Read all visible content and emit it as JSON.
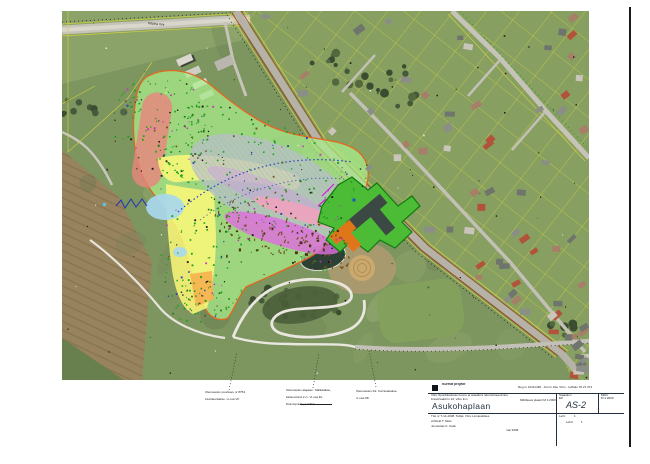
{
  "map": {
    "road_label": "Räpina mnt"
  },
  "annotations": [
    {
      "lines": [
        "Olemasolev puurkaev nr 8754.",
        "Likvideeritakse, vt osa VK"
      ]
    },
    {
      "lines": [
        "Olemasolev alajaam. Säilitatakse,",
        "kaitsevöönd 2 m. Vt osa EL",
        "liitumispunkt peakilbis"
      ]
    },
    {
      "lines": [
        "Olemasolev tiik. Korrastatakse,",
        "vt osa AB"
      ]
    }
  ],
  "title_block": {
    "logo_text": "Kurmik projekt",
    "top_right_line": "Reg nr 10411438 · Jüri tn 19a, Võru · tel/faks 78 21 373",
    "project_line1": "Võru Spordikeskuse hoone ja staadioni rekonstrueerimine",
    "project_line2": "Kreutzwaldi tn 16, Võru linn",
    "stage_note": "Mõõtkava plaanil M 1:2000",
    "title_main": "Asukohaplaan",
    "col_header1": "Staadium",
    "col_value1": "EP",
    "col_header2": "Mõõt",
    "col_value2": "M 1:2000",
    "code": "AS-2",
    "row3_line1": "Töö nr T-14-2008. Tellija: Võru Linnavalitsus",
    "row3_line2": "Arhitekt   T. Mets",
    "row3_line3": "Joonestas  K. Kask",
    "row3_center": "mai 2008",
    "sheet_label1": "Leht:",
    "sheet_value1": "1",
    "sheet_label2": "Lehti:",
    "sheet_value2": "1"
  },
  "colors": {
    "overlay_green": "#abef8c",
    "overlay_yellow": "#fbf878",
    "overlay_salmon": "#e8857c",
    "overlay_blue": "#a8d8ee",
    "overlay_magenta": "#de6ede",
    "overlay_pink": "#f2a2bc",
    "overlay_orange": "#f6b14e",
    "boundary_orange": "#e06820",
    "site_green": "#4cbb35",
    "building_orange": "#e0761a",
    "parcel_yellow": "#d6d23c"
  }
}
